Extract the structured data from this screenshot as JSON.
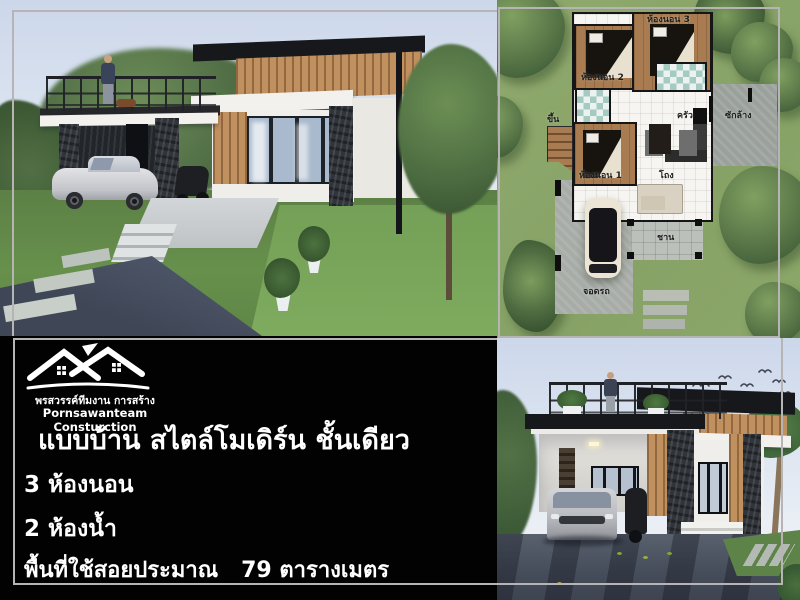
{
  "poster": {
    "brand": {
      "name_thai": "พรสวรรค์ทีมงาน การสร้าง",
      "name_en": "Pornsawanteam Consturction"
    },
    "headline": "แบบบ้าน สไตล์โมเดิร์น ชั้นเดียว",
    "specs": {
      "bedrooms": "3 ห้องนอน",
      "bathrooms": "2 ห้องน้ำ",
      "area": "พื้นที่ใช้สอยประมาณ   79 ตารางเมตร"
    }
  },
  "floor_plan": {
    "labels": {
      "bedroom1": "ห้องนอน 1",
      "bedroom2": "ห้องนอน 2",
      "bedroom3": "ห้องนอน 3",
      "kitchen": "ครัว",
      "laundry": "ซักล้าง",
      "hall": "โถง",
      "terrace": "ชาน",
      "parking": "จอดรถ",
      "up": "ขึ้น"
    }
  },
  "colors": {
    "panel_bg": "#020202",
    "frame_gray": "#b6b4b5",
    "plan_green": "#8ca769",
    "sky_blue": "#ccd7ea",
    "wood": "#c0905f",
    "stone": "#31353b",
    "text_white": "#ffffff"
  }
}
